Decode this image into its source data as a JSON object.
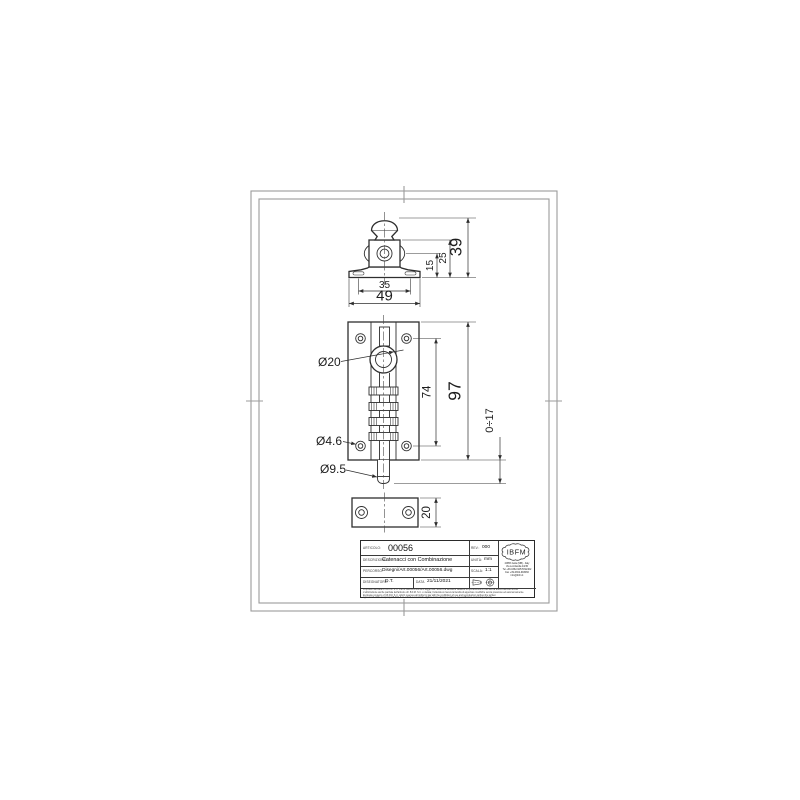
{
  "dims": {
    "inner_width": "35",
    "outer_width": "49",
    "base_to_hole": "15",
    "base_to_body": "25",
    "bracket_height": "39",
    "knob_diameter": "Ø20",
    "hole_pitch": "74",
    "plate_height": "97",
    "throw_range": "0÷17",
    "fix_hole_diameter": "Ø4.6",
    "pin_diameter": "Ø9.5",
    "keeper_height": "20"
  },
  "title_block": {
    "article_label": "ARTICOLO:",
    "article_value": "00056",
    "description_label": "DESCRIZIONE:",
    "description_value": "Catenacci con Combinazione",
    "path_label": "PERCORSO:",
    "path_value": "Disegni/Art.00056/Art.00056.dwg",
    "drafter_label": "DISEGNATORE:",
    "drafter_value": "D.T.",
    "date_label": "DATA",
    "date_value": "21/11/2021",
    "rev_label": "REV.:",
    "rev_value": "000",
    "unit_label": "UNITÀ:",
    "unit_value": "mm",
    "scale_label": "SCALA:",
    "scale_value": "1:1",
    "logo_text": "IBFM",
    "address_lines": [
      "20853 Isola (MB) - Italy",
      "Via Lombardia 43/45",
      "Tel +39-0362-92570/92402",
      "Fax +39-0362-993066",
      "info@ibfm.it"
    ],
    "disclaimer_lines": [
      "Proprietà riservata di I.B.F.M. S.r.l. che si riserva a norma di legge tutti i diritti e la facoltà di vietarne la riproduzione e l'uso senza autorizzazione scritta.",
      "L'utilizzazione anche parziale dell'articolo di I.B.F.M. S.r.l. è vietata; l'azienda si riserva la facoltà di apportare modifiche senza preavviso ed autonomamente.",
      "Exclusive property of I.B.F.M. S.r.l. which reserves all rights by law with the prohibition of use and reproduction without the written",
      "agreement of the company I.B.F.M. S.r.l. which reserves the right to make changes without any notification and independently."
    ]
  }
}
